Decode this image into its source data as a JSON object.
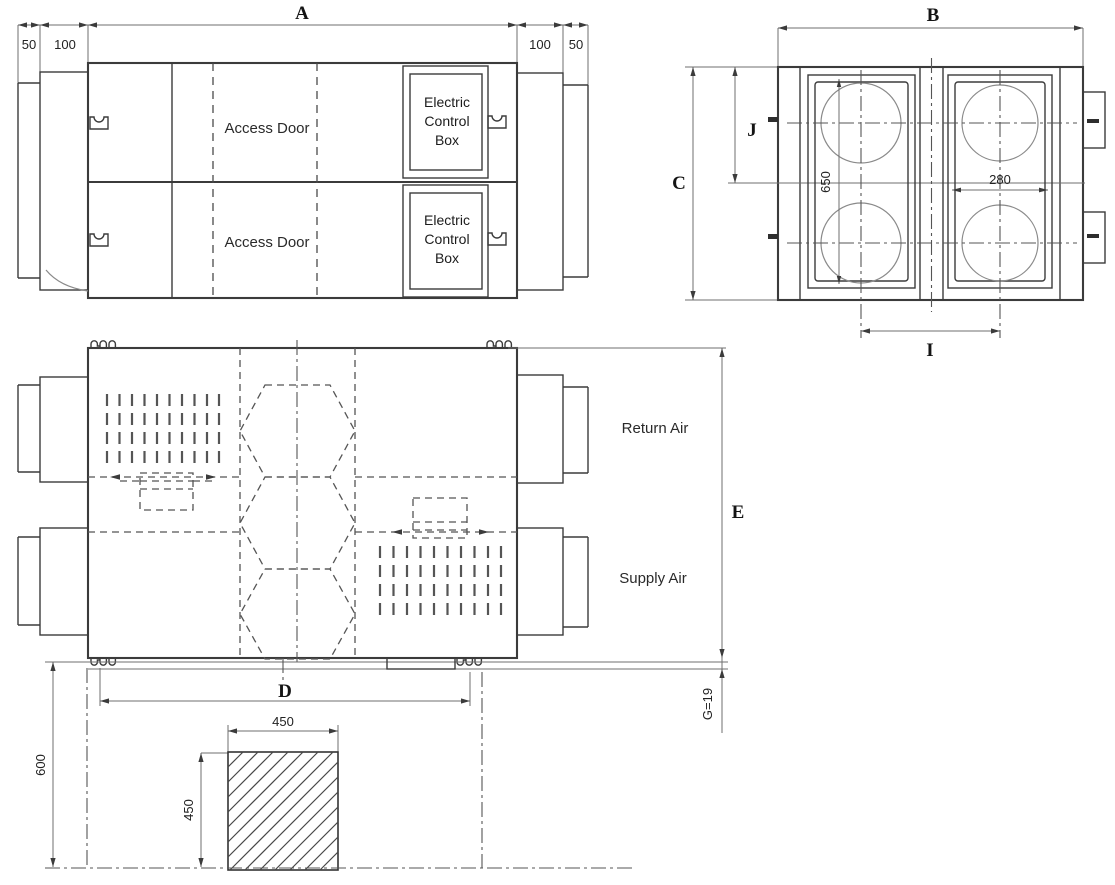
{
  "front_view": {
    "dim_a": "A",
    "dims_left": [
      "50",
      "100"
    ],
    "dims_right": [
      "100",
      "50"
    ],
    "access_doors": [
      "Access Door",
      "Access Door"
    ],
    "electric_box": [
      "Electric",
      "Control",
      "Box"
    ]
  },
  "end_view": {
    "dim_b": "B",
    "dim_c": "C",
    "dim_j": "J",
    "dim_650": "650",
    "dim_280": "280",
    "dim_i": "I"
  },
  "plan_view": {
    "return_air": "Return Air",
    "supply_air": "Supply Air",
    "dim_d": "D",
    "dim_e": "E",
    "dim_g": "G=19"
  },
  "foundation": {
    "dim_600": "600",
    "dim_450_width": "450",
    "dim_450_height": "450"
  },
  "colors": {
    "line": "#3b3b3b",
    "light": "#8a8a8a",
    "text": "#1c1c1c",
    "background": "#ffffff"
  }
}
